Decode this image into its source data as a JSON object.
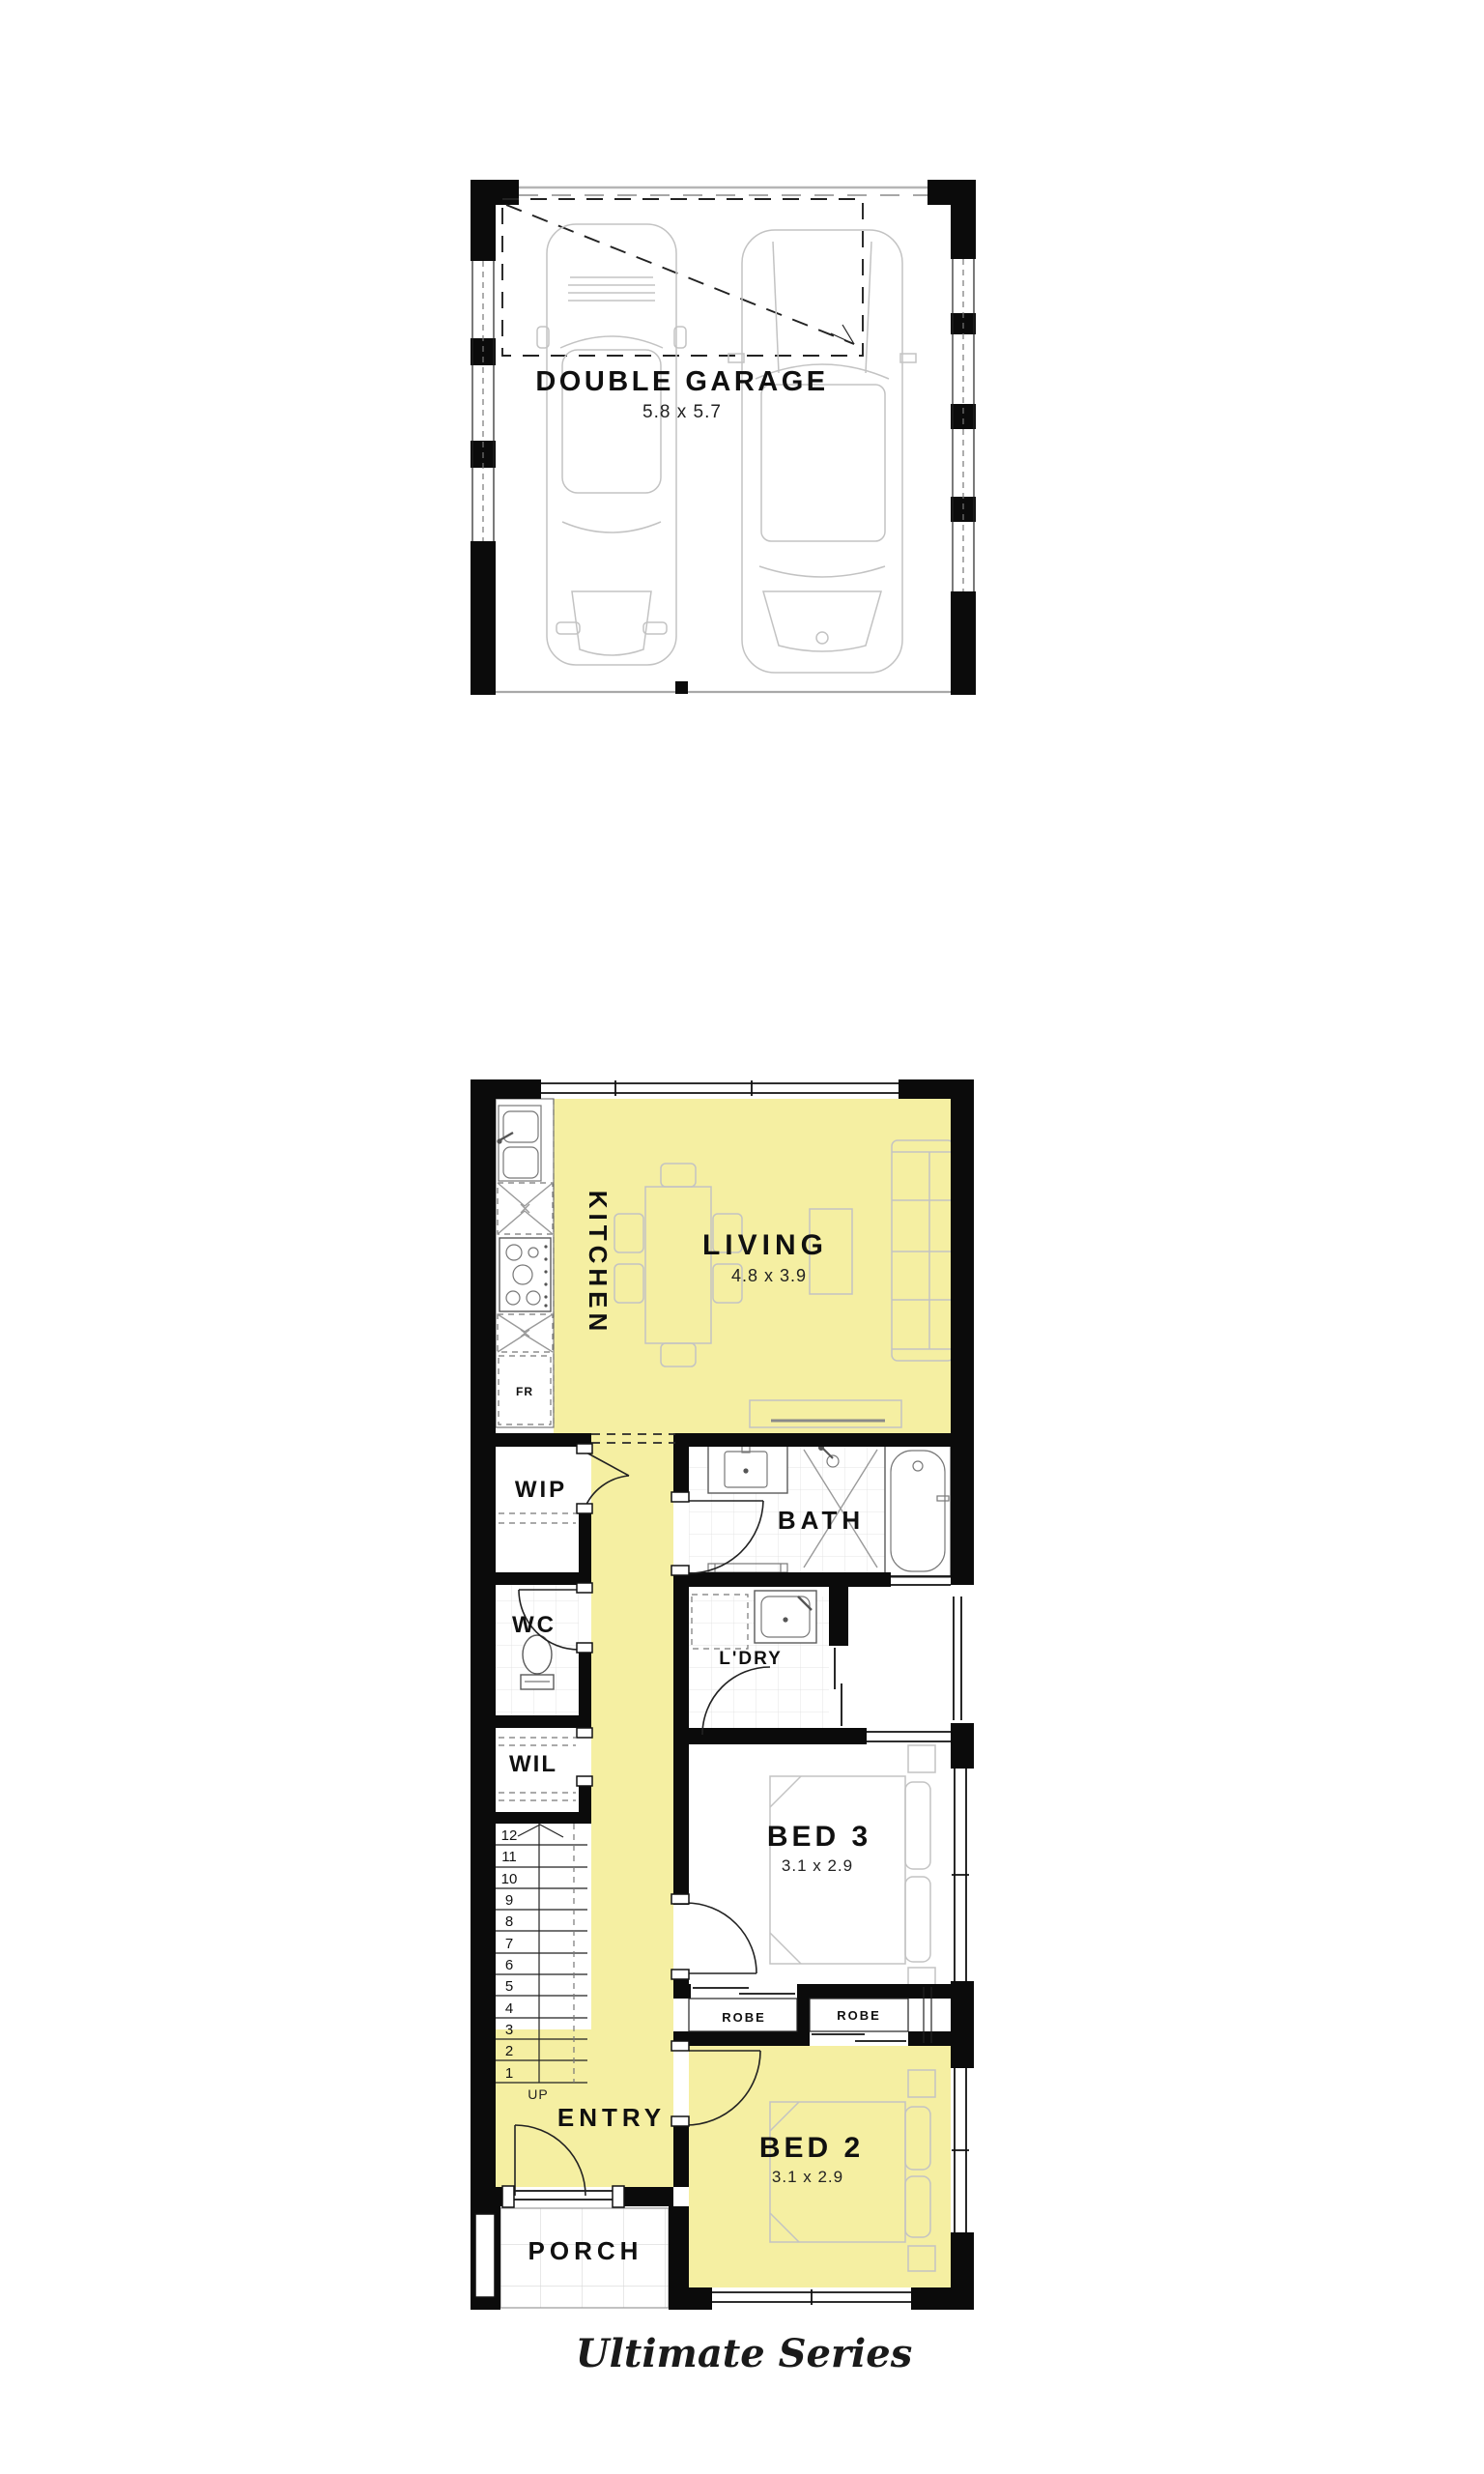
{
  "series_label": "Ultimate Series",
  "garage": {
    "name": "DOUBLE GARAGE",
    "size": "5.8 x 5.7"
  },
  "ground_floor": {
    "kitchen": "KITCHEN",
    "living": "LIVING",
    "living_size": "4.8 x 3.9",
    "wip": "WIP",
    "bath": "BATH",
    "wc": "WC",
    "ldry": "L'DRY",
    "wil": "WIL",
    "bed3": "BED 3",
    "bed3_size": "3.1 x 2.9",
    "robe_left": "ROBE",
    "robe_right": "ROBE",
    "entry": "ENTRY",
    "bed2": "BED 2",
    "bed2_size": "3.1 x 2.9",
    "porch": "PORCH",
    "fridge": "FR",
    "up": "UP",
    "stairs_steps": [
      "1",
      "2",
      "3",
      "4",
      "5",
      "6",
      "7",
      "8",
      "9",
      "10",
      "11",
      "12"
    ]
  },
  "colors": {
    "highlight": "#F5EFA2",
    "wall": "#0b0b0b",
    "furniture_line": "#c3c3c3"
  }
}
